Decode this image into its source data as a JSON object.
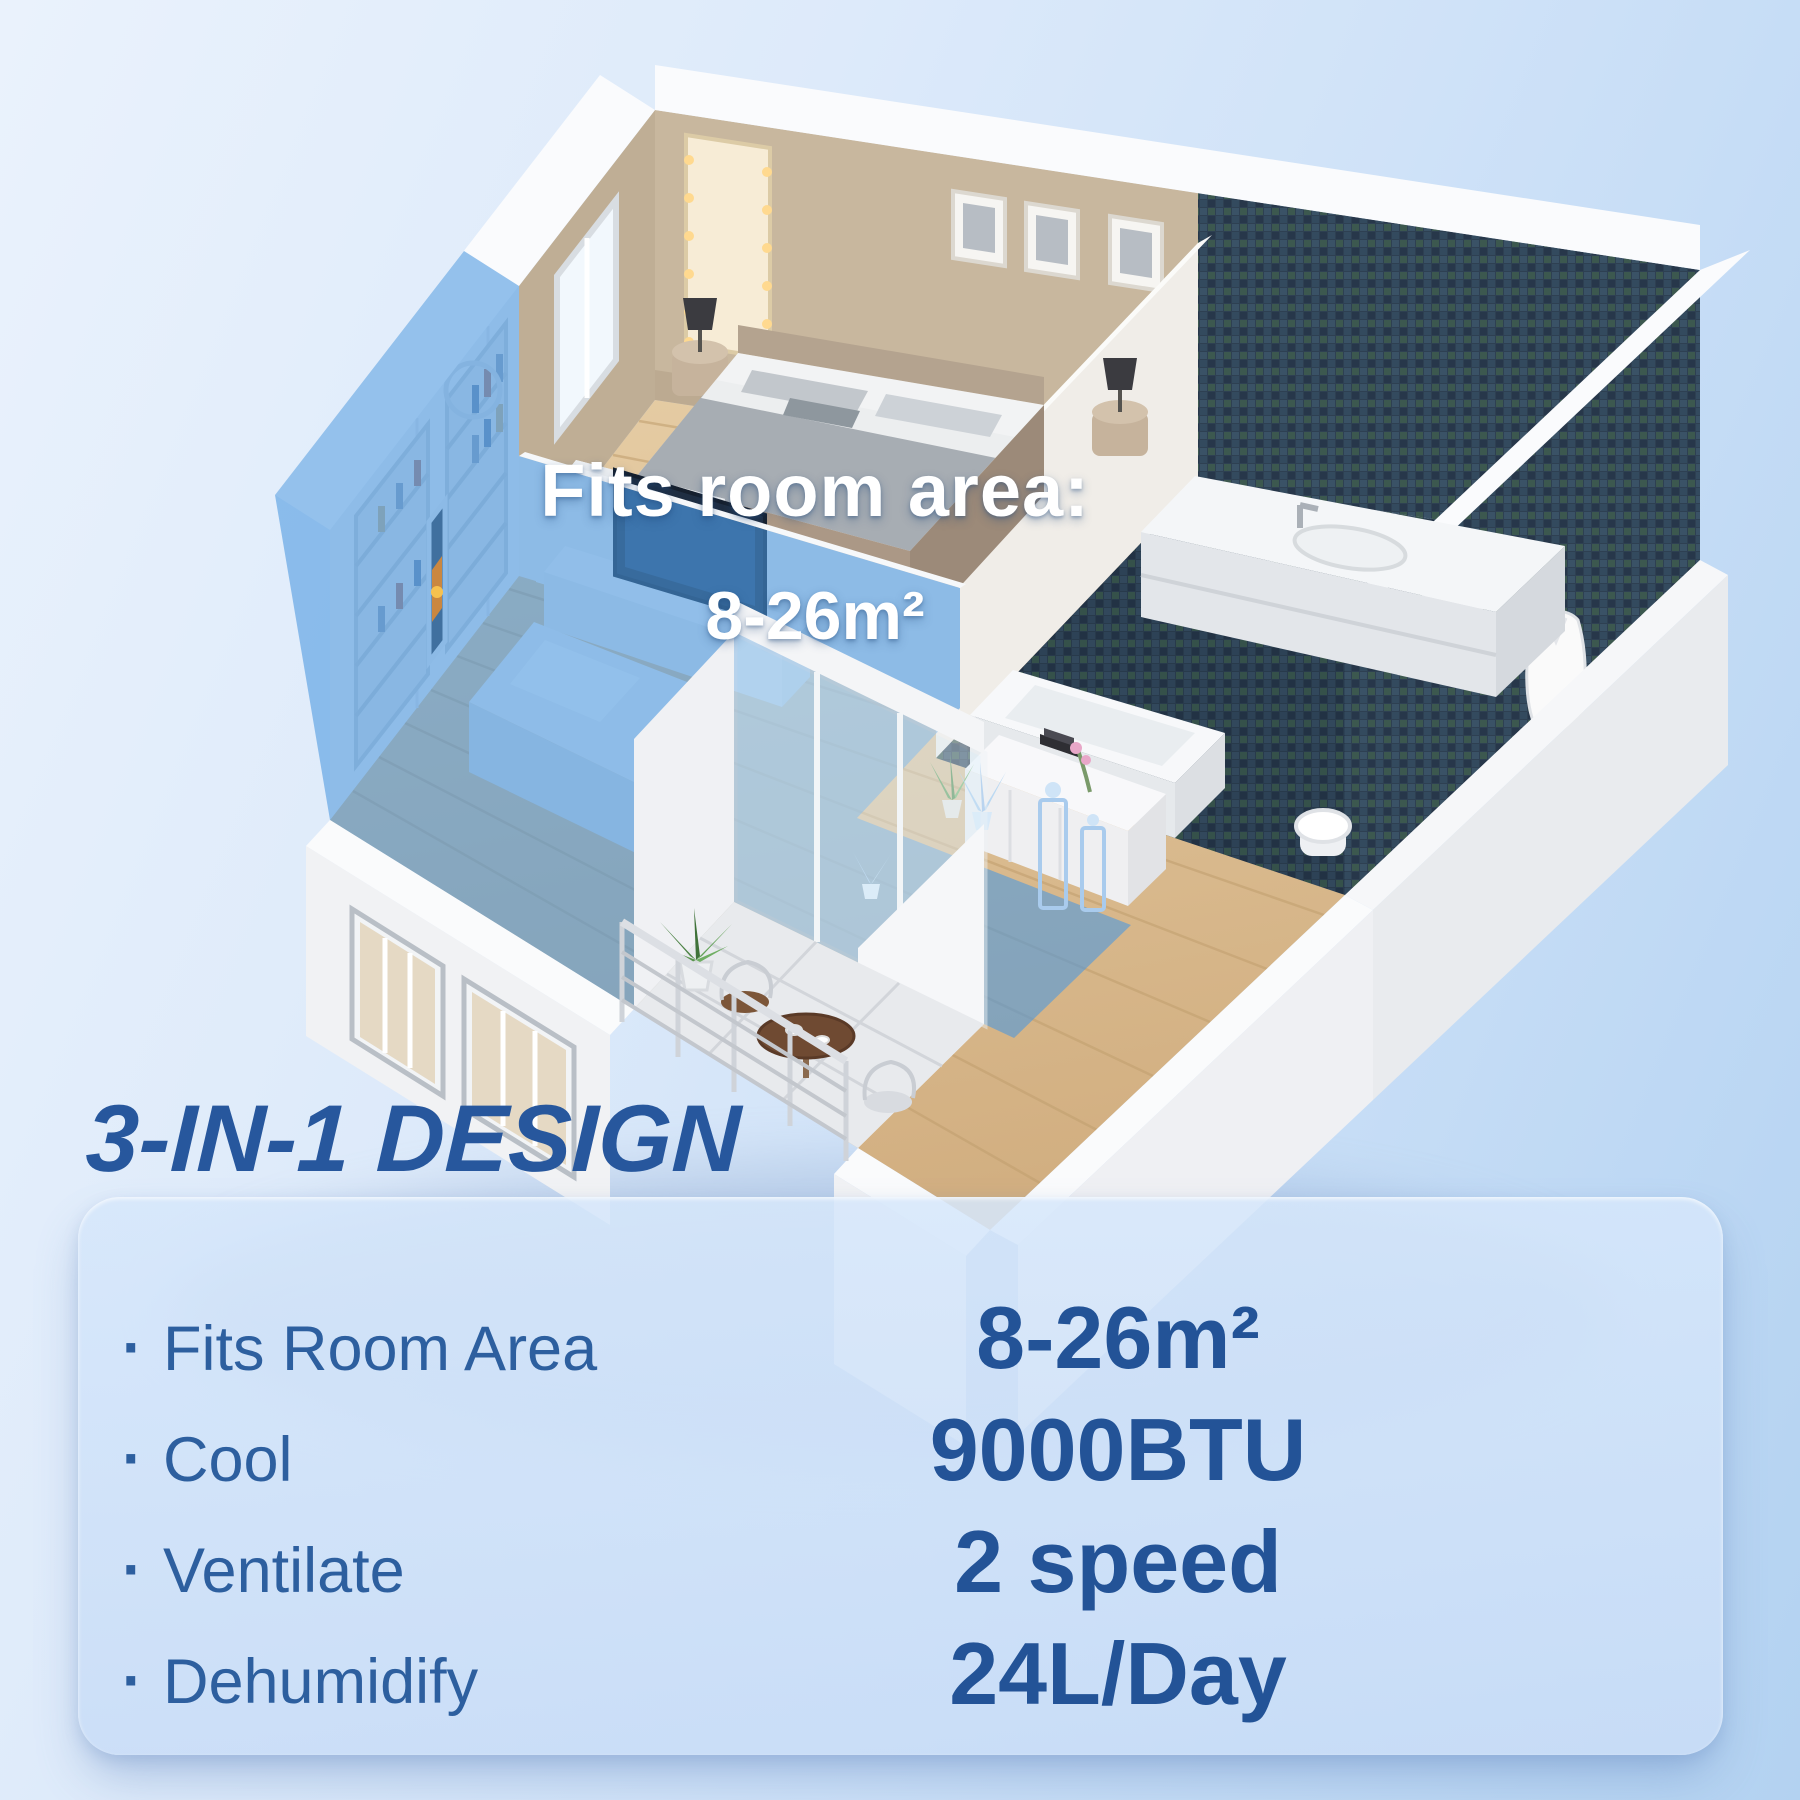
{
  "render": {
    "highlight_label_line1": "Fits room area:",
    "highlight_label_line2": "8-26m²"
  },
  "section": {
    "heading": "3-IN-1 DESIGN"
  },
  "panel": {
    "bullet": "·",
    "features": [
      "Fits Room Area",
      "Cool",
      "Ventilate",
      "Dehumidify"
    ],
    "specs": [
      "8-26m²",
      "9000BTU",
      "2 speed",
      "24L/Day"
    ]
  },
  "colors": {
    "accent_blue": "#27579d",
    "list_blue": "#2d5f9f",
    "highlight_overlay_blue": "#4a97e0",
    "panel_background": "#cfe0f8",
    "page_background_top": "#eaf2fc",
    "page_background_bottom": "#b3d2f1",
    "text_white": "#ffffff"
  }
}
